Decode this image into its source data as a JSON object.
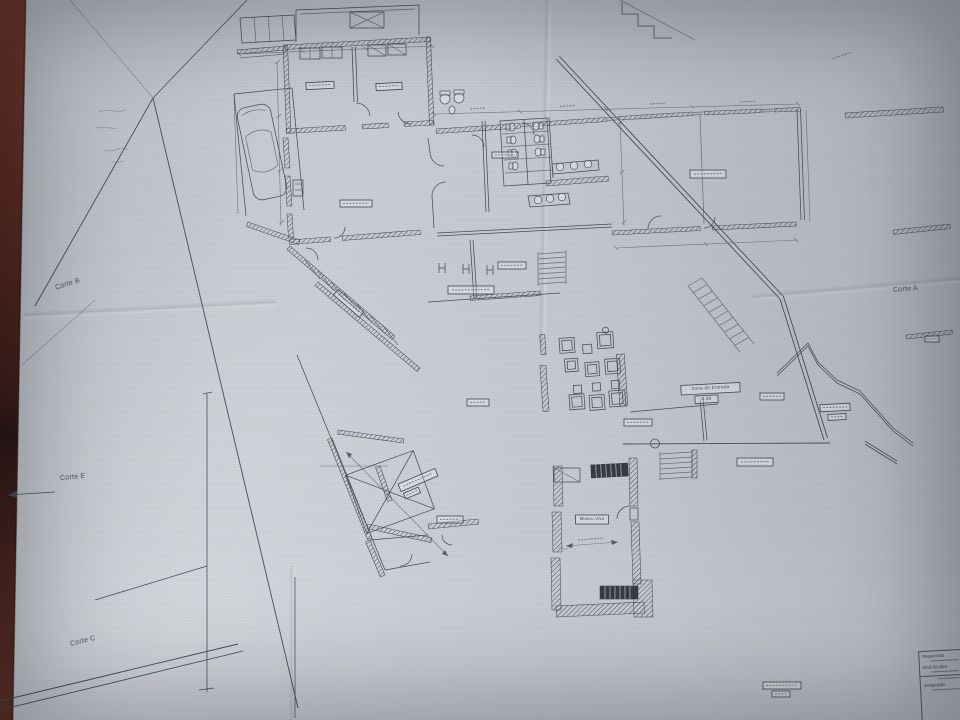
{
  "photo": {
    "subject": "architectural floor plan drawing photographed on a table",
    "table_color": "#5e2b20",
    "paper_color": "#c7cbd1",
    "ink_color": "#3e4550"
  },
  "section_labels": {
    "corte_b": "Corte B",
    "corte_e": "Corte E",
    "corte_c": "Corte C",
    "corte_a": "Corte A"
  },
  "plan_labels": {
    "entrance_zone": "Zona de Entrada",
    "entrance_level": "0.00",
    "museum_room": "Museu Vivo"
  },
  "title_block": {
    "applicant_label": "Requerente",
    "site_label": "local da obra",
    "designation_label": "designação"
  }
}
